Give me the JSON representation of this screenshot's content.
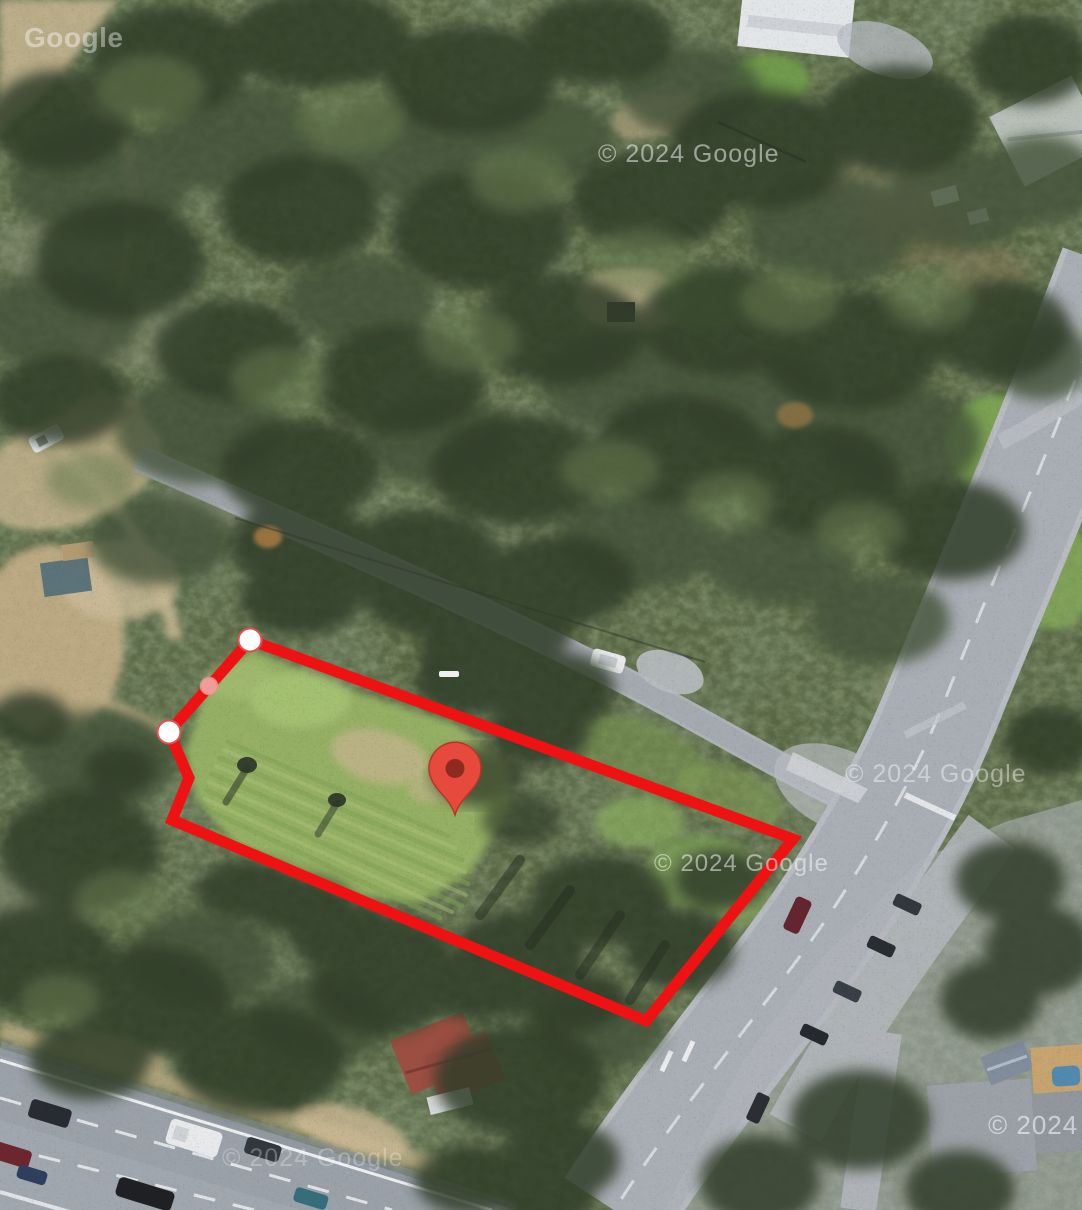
{
  "map": {
    "view_type": "satellite",
    "logo_watermark": "Google",
    "attribution_watermark": "© 2024 Google"
  },
  "overlay": {
    "boundary": {
      "label": "property-boundary",
      "stroke_color": "#ef1212",
      "stroke_width": 11,
      "vertices": [
        [
          250,
          640
        ],
        [
          793,
          839
        ],
        [
          646,
          1021
        ],
        [
          172,
          820
        ],
        [
          189,
          778
        ],
        [
          169,
          732
        ]
      ]
    },
    "handles": {
      "vertex_fill": "#ffffff",
      "vertex_ring": "#e05050",
      "vertex_radius": 11.5,
      "vertex_points": [
        [
          250,
          640
        ],
        [
          169,
          732
        ]
      ],
      "midpoint_fill": "#efa3a0",
      "midpoint_ring": "#e98f8c",
      "midpoint_radius": 8.5,
      "midpoint_points": [
        [
          209,
          686
        ]
      ]
    },
    "marker": {
      "x": 455,
      "y": 815,
      "body_color": "#e64a3d",
      "outline_color": "#b93425",
      "dot_color": "#8e2a20"
    },
    "road_dash": {
      "x": 439,
      "y": 671,
      "w": 20,
      "h": 6,
      "color": "#ffffff"
    }
  }
}
